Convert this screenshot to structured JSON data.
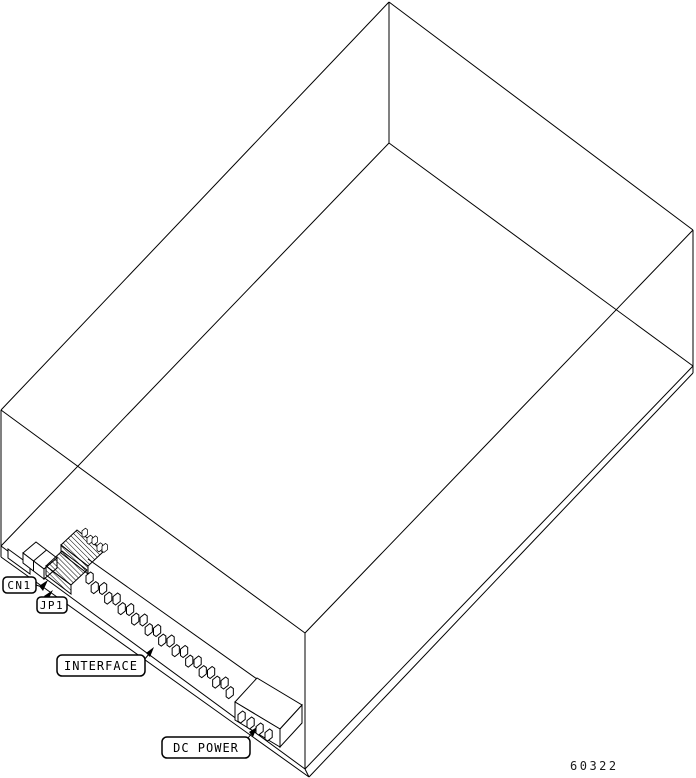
{
  "figure": {
    "number": "60322",
    "callouts": [
      {
        "id": "cn1",
        "label": "CN1"
      },
      {
        "id": "jp1",
        "label": "JP1"
      },
      {
        "id": "interface",
        "label": "INTERFACE"
      },
      {
        "id": "dc-power",
        "label": "DC POWER"
      }
    ],
    "components": [
      "drive-enclosure-wireframe",
      "cn1-connector",
      "jp1-jumper-block",
      "interface-connector-pin-row",
      "dc-power-connector"
    ],
    "colors": {
      "line": "#000000",
      "background": "#ffffff"
    }
  }
}
